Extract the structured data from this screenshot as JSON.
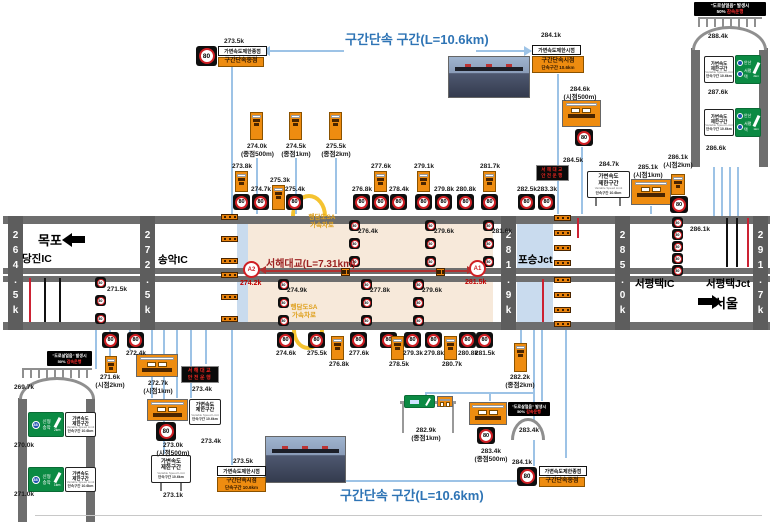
{
  "titles": {
    "section_top": "구간단속 구간(L=10.6km)",
    "section_bottom": "구간단속 구간(L=10.6km)",
    "bridge": "서해대교(L=7.31km)"
  },
  "speed": "80",
  "ice_warning": {
    "line1": "\"도로살얼음\" 발생시",
    "pct": "50%",
    "slow": "감속운행"
  },
  "led_warning": {
    "line1": "서해대교",
    "line2": "안전운행"
  },
  "places": {
    "mokpo": "목포",
    "seoul": "서울",
    "dangjin_ic": "당진IC",
    "songak_ic": "송악IC",
    "poseung_jct": "포승Jct",
    "seopyeongtaek_ic": "서평택IC",
    "seopyeongtaek_jct": "서평택Jct"
  },
  "km_posts": [
    "264.5k",
    "272.5k",
    "281.9k",
    "285.0k",
    "291.7k"
  ],
  "bridge_markers": {
    "a2_id": "A2",
    "a2_km": "274.2k",
    "a1_id": "A1",
    "a1_km": "281.5k"
  },
  "sa_ramp": {
    "line1": "행담도SA",
    "line2": "가속차로"
  },
  "combo": {
    "end_white": "가변속도제한종점",
    "end_orange": "구간단속종점",
    "start_white": "가변속도제한시점",
    "start_orange1": "구간단속시점",
    "start_orange2": "단속구간 10.6km"
  },
  "vsl_sign": {
    "l1": "가변속도",
    "l2": "제한구간",
    "l3": "Variable Speed Limit",
    "l4": "단속구간 10.6km"
  },
  "green_left": {
    "route": "38",
    "n1": "신형",
    "n2": "송악",
    "d1": "2km",
    "d2": "1km"
  },
  "green_right": {
    "n1": "안산",
    "n2": "서평택",
    "d1": "2km",
    "d2": "1km"
  },
  "top_combo_end_km": "273.5k",
  "top_combo_start_km": "284.1k",
  "bottom_combo_start_km": "273.5k",
  "bottom_combo_end_km": "284.1k",
  "top_countdown": [
    {
      "km": "274.0k",
      "sub": "(종점500m)",
      "x": 250
    },
    {
      "km": "274.5k",
      "sub": "(종점1km)",
      "x": 289
    },
    {
      "km": "275.5k",
      "sub": "(종점2km)",
      "x": 329
    }
  ],
  "top_row": [
    {
      "x": 233,
      "km": "273.8k",
      "t": "os"
    },
    {
      "x": 252,
      "km": "274.7k",
      "t": "s"
    },
    {
      "x": 271,
      "km": "275.3k",
      "t": "o"
    },
    {
      "x": 286,
      "km": "275.4k",
      "t": "s"
    },
    {
      "x": 353,
      "km": "276.8k",
      "t": "s"
    },
    {
      "x": 372,
      "km": "277.6k",
      "t": "os"
    },
    {
      "x": 390,
      "km": "278.4k",
      "t": "s"
    },
    {
      "x": 415,
      "km": "279.1k",
      "t": "os"
    },
    {
      "x": 435,
      "km": "279.8k",
      "t": "s"
    },
    {
      "x": 457,
      "km": "280.8k",
      "t": "s"
    },
    {
      "x": 481,
      "km": "281.7k",
      "t": "os"
    },
    {
      "x": 518,
      "km": "282.5k",
      "t": "s"
    },
    {
      "x": 538,
      "km": "283.3k",
      "t": "s"
    }
  ],
  "bottom_row": [
    {
      "x": 102,
      "km": "",
      "t": "s"
    },
    {
      "x": 127,
      "km": "272.4k",
      "t": "s"
    },
    {
      "x": 277,
      "km": "274.6k",
      "t": "s"
    },
    {
      "x": 308,
      "km": "275.5k",
      "t": "s"
    },
    {
      "x": 330,
      "km": "276.8k",
      "t": "o"
    },
    {
      "x": 350,
      "km": "277.6k",
      "t": "s"
    },
    {
      "x": 380,
      "km": "",
      "t": "s"
    },
    {
      "x": 390,
      "km": "278.5k",
      "t": "o"
    },
    {
      "x": 404,
      "km": "279.3k",
      "t": "s"
    },
    {
      "x": 425,
      "km": "279.8k",
      "t": "s"
    },
    {
      "x": 443,
      "km": "280.7k",
      "t": "o"
    },
    {
      "x": 459,
      "km": "280.8k",
      "t": "s"
    },
    {
      "x": 476,
      "km": "281.5k",
      "t": "s"
    }
  ],
  "left_cluster": {
    "c271_6_km": "271.6k",
    "c271_6_sub": "(시점2km)",
    "c272_7_km": "272.7k",
    "c272_7_sub": "(시점1km)",
    "led_km": "273.4k",
    "c273_0_km": "273.0k",
    "c273_0_sub": "(시점500m)",
    "vsl1_km": "273.4k",
    "vsl2_km": "273.1k"
  },
  "right_cluster": {
    "c284_6_km": "284.6k",
    "c284_6_sub": "(시점500m)",
    "led_km": "284.5k",
    "vsl_km": "284.7k",
    "c285_1_km": "285.1k",
    "c285_1_sub": "(시점1km)",
    "c286_1_km": "286.1k",
    "c286_1_sub": "(시점2km)"
  },
  "bottom_right_cluster": {
    "c282_2_km": "282.2k",
    "c282_2_sub": "(종점2km)",
    "c282_9_km": "282.9k",
    "c282_9_sub": "(종점1km)",
    "c283_4a_km": "283.4k",
    "c283_4a_sub": "(종점500m)",
    "c283_4b_km": "283.4k"
  },
  "road_columns": [
    {
      "x": 95,
      "y": 277,
      "n": 3,
      "step": 18,
      "km": "271.5k",
      "lx": 105,
      "ly": 286
    },
    {
      "x": 349,
      "y": 220,
      "n": 3,
      "step": 18,
      "km": "276.4k",
      "lx": 356,
      "ly": 228
    },
    {
      "x": 425,
      "y": 220,
      "n": 3,
      "step": 18,
      "km": "279.6k",
      "lx": 432,
      "ly": 228
    },
    {
      "x": 483,
      "y": 220,
      "n": 3,
      "step": 18,
      "km": "281.6k",
      "lx": 490,
      "ly": 228
    },
    {
      "x": 278,
      "y": 279,
      "n": 3,
      "step": 18,
      "km": "274.9k",
      "lx": 285,
      "ly": 287
    },
    {
      "x": 361,
      "y": 279,
      "n": 3,
      "step": 18,
      "km": "277.8k",
      "lx": 368,
      "ly": 287
    },
    {
      "x": 413,
      "y": 279,
      "n": 3,
      "step": 18,
      "km": "279.6k",
      "lx": 420,
      "ly": 287
    },
    {
      "x": 672,
      "y": 217,
      "n": 5,
      "step": 12,
      "km": "286.1k",
      "lx": 688,
      "ly": 226
    }
  ],
  "vertical_road_right_markers": [
    "288.4k",
    "287.6k",
    "286.6k"
  ],
  "vertical_road_left_markers": [
    "269.7k",
    "270.0k",
    "271.0k"
  ]
}
